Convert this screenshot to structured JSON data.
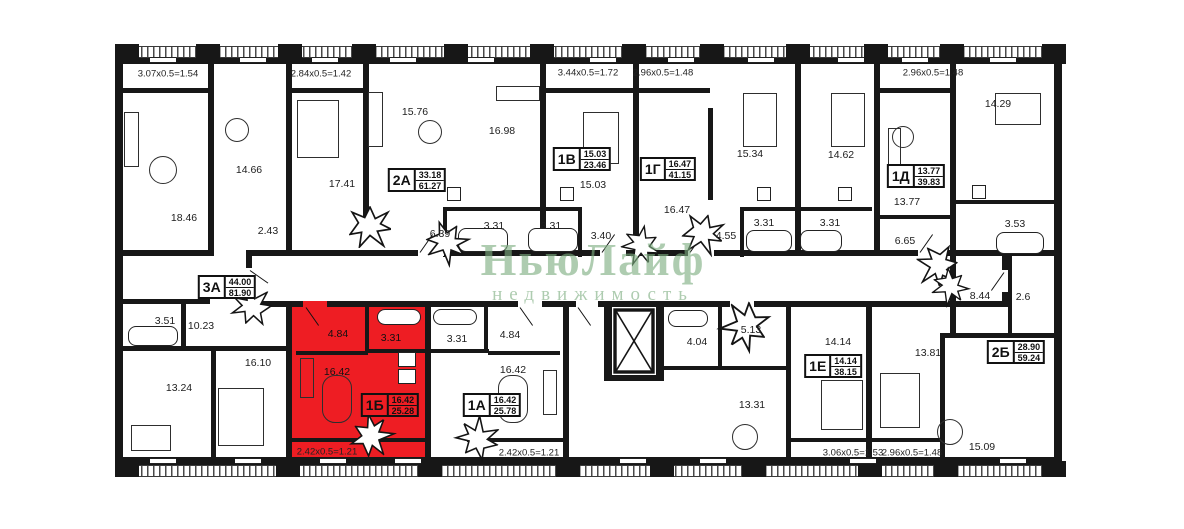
{
  "watermark": {
    "line1": "НьюЛайф",
    "line2": "недвижимость"
  },
  "colors": {
    "highlight": "#ee1d23",
    "wall": "#171717",
    "watermark_green": "#7dae80"
  },
  "badges": [
    {
      "id": "3a",
      "label": "3А",
      "living": "44.00",
      "total": "81.90",
      "x": 227,
      "y": 287,
      "highlighted": false
    },
    {
      "id": "2a",
      "label": "2А",
      "living": "33.18",
      "total": "61.27",
      "x": 417,
      "y": 180,
      "highlighted": false
    },
    {
      "id": "1v",
      "label": "1В",
      "living": "15.03",
      "total": "23.46",
      "x": 582,
      "y": 159,
      "highlighted": false
    },
    {
      "id": "1g",
      "label": "1Г",
      "living": "16.47",
      "total": "41.15",
      "x": 668,
      "y": 169,
      "highlighted": false
    },
    {
      "id": "1d",
      "label": "1Д",
      "living": "13.77",
      "total": "39.83",
      "x": 916,
      "y": 176,
      "highlighted": false
    },
    {
      "id": "2b",
      "label": "2Б",
      "living": "28.90",
      "total": "59.24",
      "x": 1016,
      "y": 352,
      "highlighted": false
    },
    {
      "id": "1e",
      "label": "1Е",
      "living": "14.14",
      "total": "38.15",
      "x": 833,
      "y": 366,
      "highlighted": false
    },
    {
      "id": "1a",
      "label": "1А",
      "living": "16.42",
      "total": "25.78",
      "x": 492,
      "y": 405,
      "highlighted": false
    },
    {
      "id": "1b",
      "label": "1Б",
      "living": "16.42",
      "total": "25.28",
      "x": 390,
      "y": 405,
      "highlighted": true
    }
  ],
  "room_labels": [
    {
      "text": "18.46",
      "x": 184,
      "y": 218
    },
    {
      "text": "14.66",
      "x": 249,
      "y": 170
    },
    {
      "text": "2.43",
      "x": 268,
      "y": 231
    },
    {
      "text": "17.41",
      "x": 342,
      "y": 184
    },
    {
      "text": "15.76",
      "x": 415,
      "y": 112
    },
    {
      "text": "16.98",
      "x": 502,
      "y": 131
    },
    {
      "text": "6.39",
      "x": 440,
      "y": 234
    },
    {
      "text": "3.31",
      "x": 494,
      "y": 226
    },
    {
      "text": "3.31",
      "x": 551,
      "y": 226
    },
    {
      "text": "15.03",
      "x": 593,
      "y": 185
    },
    {
      "text": "3.40",
      "x": 601,
      "y": 236
    },
    {
      "text": "16.47",
      "x": 677,
      "y": 210
    },
    {
      "text": "15.34",
      "x": 750,
      "y": 154
    },
    {
      "text": "4.55",
      "x": 726,
      "y": 236
    },
    {
      "text": "3.31",
      "x": 764,
      "y": 223
    },
    {
      "text": "3.31",
      "x": 830,
      "y": 223
    },
    {
      "text": "14.62",
      "x": 841,
      "y": 155
    },
    {
      "text": "13.77",
      "x": 907,
      "y": 202
    },
    {
      "text": "6.65",
      "x": 905,
      "y": 241
    },
    {
      "text": "14.29",
      "x": 998,
      "y": 104
    },
    {
      "text": "3.53",
      "x": 1015,
      "y": 224
    },
    {
      "text": "3.51",
      "x": 165,
      "y": 321
    },
    {
      "text": "10.23",
      "x": 201,
      "y": 326
    },
    {
      "text": "13.24",
      "x": 179,
      "y": 388
    },
    {
      "text": "16.10",
      "x": 258,
      "y": 363
    },
    {
      "text": "4.84",
      "x": 338,
      "y": 334,
      "on_red": true
    },
    {
      "text": "3.31",
      "x": 391,
      "y": 338,
      "on_red": true
    },
    {
      "text": "16.42",
      "x": 337,
      "y": 372,
      "on_red": true
    },
    {
      "text": "3.31",
      "x": 457,
      "y": 339
    },
    {
      "text": "4.84",
      "x": 510,
      "y": 335
    },
    {
      "text": "16.42",
      "x": 513,
      "y": 370
    },
    {
      "text": "4.04",
      "x": 697,
      "y": 342
    },
    {
      "text": "5.13",
      "x": 751,
      "y": 330
    },
    {
      "text": "14.14",
      "x": 838,
      "y": 342
    },
    {
      "text": "13.31",
      "x": 752,
      "y": 405
    },
    {
      "text": "8.44",
      "x": 980,
      "y": 296
    },
    {
      "text": "2.6",
      "x": 1023,
      "y": 297
    },
    {
      "text": "13.81",
      "x": 928,
      "y": 353
    },
    {
      "text": "15.09",
      "x": 982,
      "y": 447
    }
  ],
  "dim_labels": [
    {
      "text": "3.07x0.5=1.54",
      "x": 168,
      "y": 74
    },
    {
      "text": "2.84x0.5=1.42",
      "x": 321,
      "y": 74
    },
    {
      "text": "3.44x0.5=1.72",
      "x": 588,
      "y": 73
    },
    {
      "text": "2.96x0.5=1.48",
      "x": 663,
      "y": 73
    },
    {
      "text": "2.96x0.5=1.48",
      "x": 933,
      "y": 73
    },
    {
      "text": "2.42x0.5=1.21",
      "x": 327,
      "y": 452,
      "on_red": true
    },
    {
      "text": "2.42x0.5=1.21",
      "x": 529,
      "y": 453
    },
    {
      "text": "3.06x0.5=1.53",
      "x": 853,
      "y": 453
    },
    {
      "text": "2.96x0.5=1.48",
      "x": 912,
      "y": 453
    }
  ]
}
